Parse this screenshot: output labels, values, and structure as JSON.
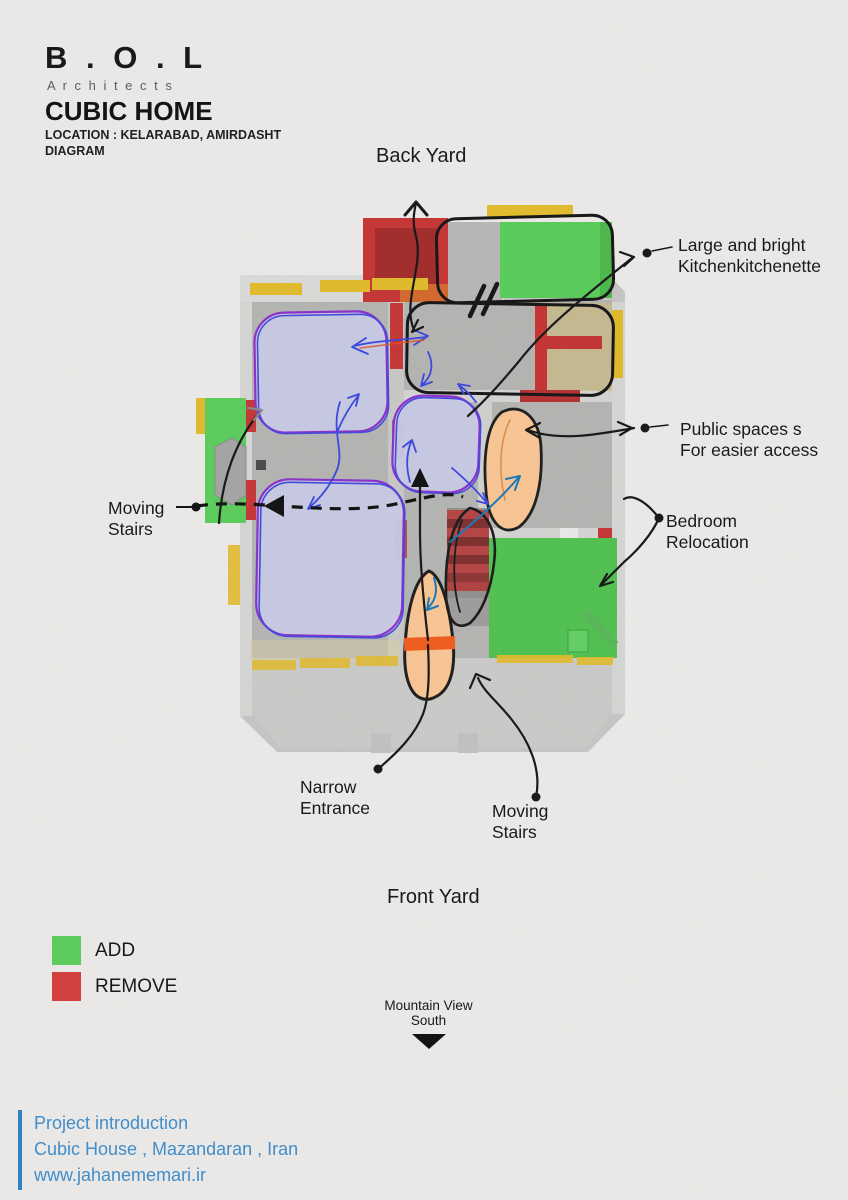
{
  "header": {
    "brand": "B . O . L",
    "brand_sub": "A r c h i t e c t s",
    "title": "CUBIC HOME",
    "location": "LOCATION : KELARABAD, AMIRDASHT",
    "doc_type": "DIAGRAM"
  },
  "plan_labels": {
    "back_yard": "Back Yard",
    "front_yard": "Front Yard",
    "kitchen_line1": "Large and bright",
    "kitchen_line2": "Kitchenkitchenette",
    "public_line1": "Public spaces s",
    "public_line2": "For easier access",
    "moving_stairs_left_line1": "Moving",
    "moving_stairs_left_line2": "Stairs",
    "bedroom_line1": "Bedroom",
    "bedroom_line2": "Relocation",
    "narrow_line1": "Narrow",
    "narrow_line2": "Entrance",
    "moving_stairs_bottom_line1": "Moving",
    "moving_stairs_bottom_line2": "Stairs"
  },
  "legend": {
    "items": [
      {
        "label": "ADD",
        "color": "#5bcb5b"
      },
      {
        "label": "REMOVE",
        "color": "#d23c3c"
      }
    ]
  },
  "compass": {
    "line1": "Mountain View",
    "line2": "South"
  },
  "footer": {
    "line1": "Project introduction",
    "line2": "Cubic House , Mazandaran , Iran",
    "line3": "www.jahanememari.ir",
    "accent": "#3e8cca"
  }
}
